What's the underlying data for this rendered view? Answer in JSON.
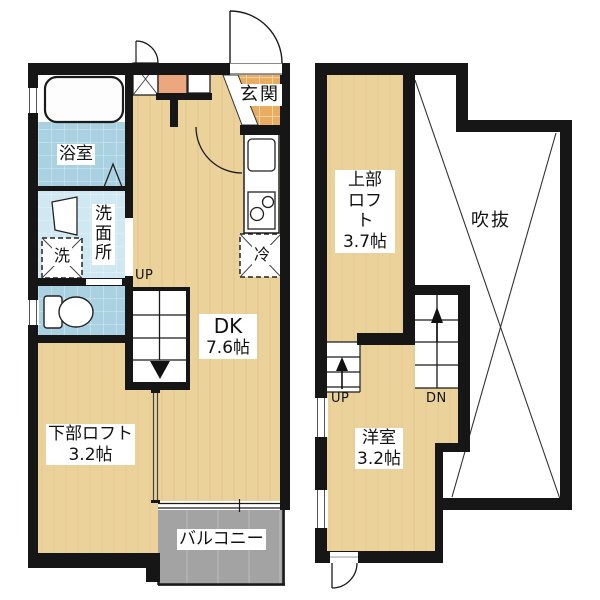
{
  "plan": {
    "floor1": {
      "bathroom_label": "浴室",
      "washroom_label": "洗面所",
      "washer_label": "洗",
      "entrance_label": "玄関",
      "dk_label": "DK",
      "dk_size": "7.6帖",
      "lower_loft_label": "下部ロフト",
      "lower_loft_size": "3.2帖",
      "balcony_label": "バルコニー",
      "refrigerator_label": "冷",
      "stairs_up_label": "UP"
    },
    "floor2": {
      "upper_loft_label": "上部ロフト",
      "upper_loft_size": "3.7帖",
      "void_label": "吹抜",
      "room_label": "洋室",
      "room_size": "3.2帖",
      "stairs_up_label": "UP",
      "stairs_down_label": "DN"
    },
    "colors": {
      "wall": "#161616",
      "wood_floor": "#ead29a",
      "entrance_tile": "#e9ad62",
      "bath_tile": "#a9d1e2",
      "washroom_tile": "#cfe8f1",
      "balcony": "#a3a3a3",
      "cabinet": "#eca77f",
      "fixture_white": "#ffffff"
    }
  }
}
